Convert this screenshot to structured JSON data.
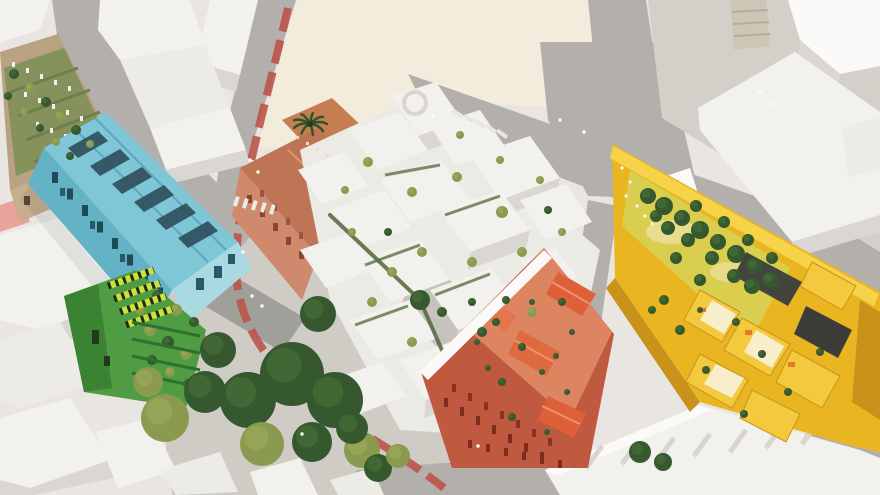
{
  "colors": {
    "bg": "#e9e6e2",
    "plaza_cream": "#f3ecdc",
    "plaza_light": "#cfccc6",
    "road": "#b3b0ab",
    "road_dark": "#a19f9a",
    "bike_lane": "#bc544a",
    "brown_roof": "#b9a183",
    "brown_face": "#c6ae8e",
    "blue_roof": "#7fc6d6",
    "blue_face": "#64b2c6",
    "blue_end": "#a9dae2",
    "blue_panel": "#2f4f5d",
    "green_main": "#4f9c42",
    "green_dark": "#3b8233",
    "lime": "#c9e23e",
    "terra_roof": "#bf7455",
    "terra_face": "#cf8a6e",
    "terra_terrace": "#c77d52",
    "white_roof": "#f4f3f0",
    "white_side": "#dbd8d3",
    "courtyard_paving": "#c6c3be",
    "coral_body": "#bf5940",
    "coral_terrace": "#dd8461",
    "coral_roof": "#dd6038",
    "yellow_body": "#e9b622",
    "yellow_light": "#f6d348",
    "yellow_side": "#c9921b",
    "yellow_court": "#d9ce4e",
    "stone": "#cdc6b7",
    "slab_dark": "#3c3c38",
    "tree_dark": "#35582e",
    "tree_mid": "#477238",
    "tree_olive": "#8a9a4e",
    "tree_olive_hi": "#9cab5c",
    "palm": "#2e5527"
  },
  "scene": {
    "plaza_trees": [
      [
        148,
        382,
        15,
        "olive"
      ],
      [
        165,
        418,
        24,
        "olive"
      ],
      [
        205,
        392,
        21,
        "dark"
      ],
      [
        248,
        400,
        28,
        "dark"
      ],
      [
        292,
        374,
        32,
        "dark"
      ],
      [
        335,
        400,
        28,
        "dark"
      ],
      [
        262,
        444,
        22,
        "olive"
      ],
      [
        312,
        442,
        20,
        "dark"
      ],
      [
        362,
        450,
        18,
        "olive"
      ],
      [
        218,
        350,
        18,
        "dark"
      ],
      [
        318,
        314,
        18,
        "dark"
      ],
      [
        352,
        428,
        16,
        "dark"
      ],
      [
        378,
        468,
        14,
        "dark"
      ],
      [
        398,
        456,
        12,
        "olive"
      ],
      [
        420,
        300,
        10,
        "dark"
      ],
      [
        640,
        452,
        11,
        "dark"
      ],
      [
        663,
        462,
        9,
        "dark"
      ]
    ],
    "courtyard_trees": [
      [
        648,
        196,
        8
      ],
      [
        664,
        206,
        9
      ],
      [
        682,
        218,
        8
      ],
      [
        700,
        230,
        9
      ],
      [
        718,
        242,
        8
      ],
      [
        736,
        254,
        9
      ],
      [
        754,
        266,
        8
      ],
      [
        688,
        240,
        7
      ],
      [
        668,
        228,
        7
      ],
      [
        712,
        258,
        7
      ],
      [
        734,
        276,
        7
      ],
      [
        752,
        286,
        8
      ],
      [
        770,
        280,
        8
      ],
      [
        656,
        216,
        6
      ],
      [
        696,
        206,
        6
      ],
      [
        724,
        222,
        6
      ],
      [
        748,
        240,
        6
      ],
      [
        772,
        258,
        6
      ],
      [
        700,
        280,
        6
      ],
      [
        676,
        258,
        6
      ],
      [
        736,
        322,
        4
      ],
      [
        762,
        354,
        4
      ],
      [
        706,
        370,
        4
      ],
      [
        788,
        392,
        4
      ],
      [
        744,
        414,
        4
      ],
      [
        820,
        352,
        4
      ],
      [
        700,
        310,
        3
      ],
      [
        664,
        300,
        5
      ],
      [
        680,
        330,
        5
      ],
      [
        652,
        310,
        4
      ]
    ],
    "coral_plants": [
      [
        472,
        302,
        4
      ],
      [
        496,
        322,
        4
      ],
      [
        522,
        347,
        4
      ],
      [
        542,
        372,
        3
      ],
      [
        502,
        382,
        4
      ],
      [
        532,
        302,
        3
      ],
      [
        562,
        302,
        4
      ],
      [
        572,
        332,
        3
      ],
      [
        477,
        342,
        3
      ],
      [
        512,
        417,
        4
      ],
      [
        547,
        432,
        3
      ],
      [
        567,
        392,
        3
      ],
      [
        488,
        368,
        3
      ],
      [
        556,
        356,
        3
      ]
    ],
    "cluster_trees": [
      [
        368,
        162,
        5,
        "olive"
      ],
      [
        412,
        192,
        5,
        "olive"
      ],
      [
        457,
        177,
        5,
        "olive"
      ],
      [
        502,
        212,
        6,
        "olive"
      ],
      [
        422,
        252,
        5,
        "olive"
      ],
      [
        392,
        272,
        5,
        "olive"
      ],
      [
        472,
        262,
        5,
        "olive"
      ],
      [
        522,
        252,
        5,
        "olive"
      ],
      [
        442,
        312,
        5,
        "dark"
      ],
      [
        482,
        332,
        5,
        "dark"
      ],
      [
        532,
        312,
        5,
        "olive"
      ],
      [
        412,
        342,
        5,
        "olive"
      ],
      [
        372,
        302,
        5,
        "olive"
      ],
      [
        352,
        232,
        4,
        "olive"
      ],
      [
        562,
        232,
        4,
        "olive"
      ],
      [
        548,
        210,
        4,
        "dark"
      ],
      [
        500,
        160,
        4,
        "olive"
      ],
      [
        540,
        180,
        4,
        "olive"
      ],
      [
        460,
        135,
        4,
        "olive"
      ],
      [
        506,
        300,
        4,
        "dark"
      ],
      [
        388,
        232,
        4,
        "dark"
      ],
      [
        345,
        190,
        4,
        "olive"
      ]
    ],
    "brown_plants": [
      [
        14,
        74,
        5
      ],
      [
        30,
        88,
        5
      ],
      [
        46,
        102,
        5
      ],
      [
        60,
        116,
        5
      ],
      [
        76,
        130,
        5
      ],
      [
        90,
        144,
        4
      ],
      [
        8,
        96,
        4
      ],
      [
        24,
        112,
        4
      ],
      [
        40,
        128,
        4
      ],
      [
        56,
        142,
        4
      ],
      [
        70,
        156,
        4
      ]
    ],
    "green_plants": [
      [
        150,
        330,
        6
      ],
      [
        168,
        342,
        6
      ],
      [
        186,
        354,
        6
      ],
      [
        152,
        360,
        5
      ],
      [
        170,
        372,
        5
      ],
      [
        188,
        384,
        5
      ],
      [
        140,
        310,
        5
      ],
      [
        158,
        296,
        6
      ],
      [
        176,
        310,
        6
      ],
      [
        194,
        322,
        5
      ]
    ],
    "people": [
      [
        252,
        296
      ],
      [
        262,
        306
      ],
      [
        243,
        252
      ],
      [
        433,
        116
      ],
      [
        449,
        110
      ],
      [
        470,
        122
      ],
      [
        302,
        434
      ],
      [
        478,
        446
      ],
      [
        560,
        120
      ],
      [
        584,
        132
      ],
      [
        250,
        160
      ],
      [
        258,
        172
      ],
      [
        772,
        104
      ],
      [
        760,
        92
      ]
    ],
    "flower_specks": [
      [
        622,
        168
      ],
      [
        630,
        182
      ],
      [
        626,
        196
      ],
      [
        637,
        206
      ],
      [
        645,
        216
      ],
      [
        652,
        224
      ]
    ],
    "terrace_furniture": [
      [
        296,
        136
      ],
      [
        306,
        142
      ],
      [
        316,
        148
      ],
      [
        326,
        154
      ]
    ]
  }
}
